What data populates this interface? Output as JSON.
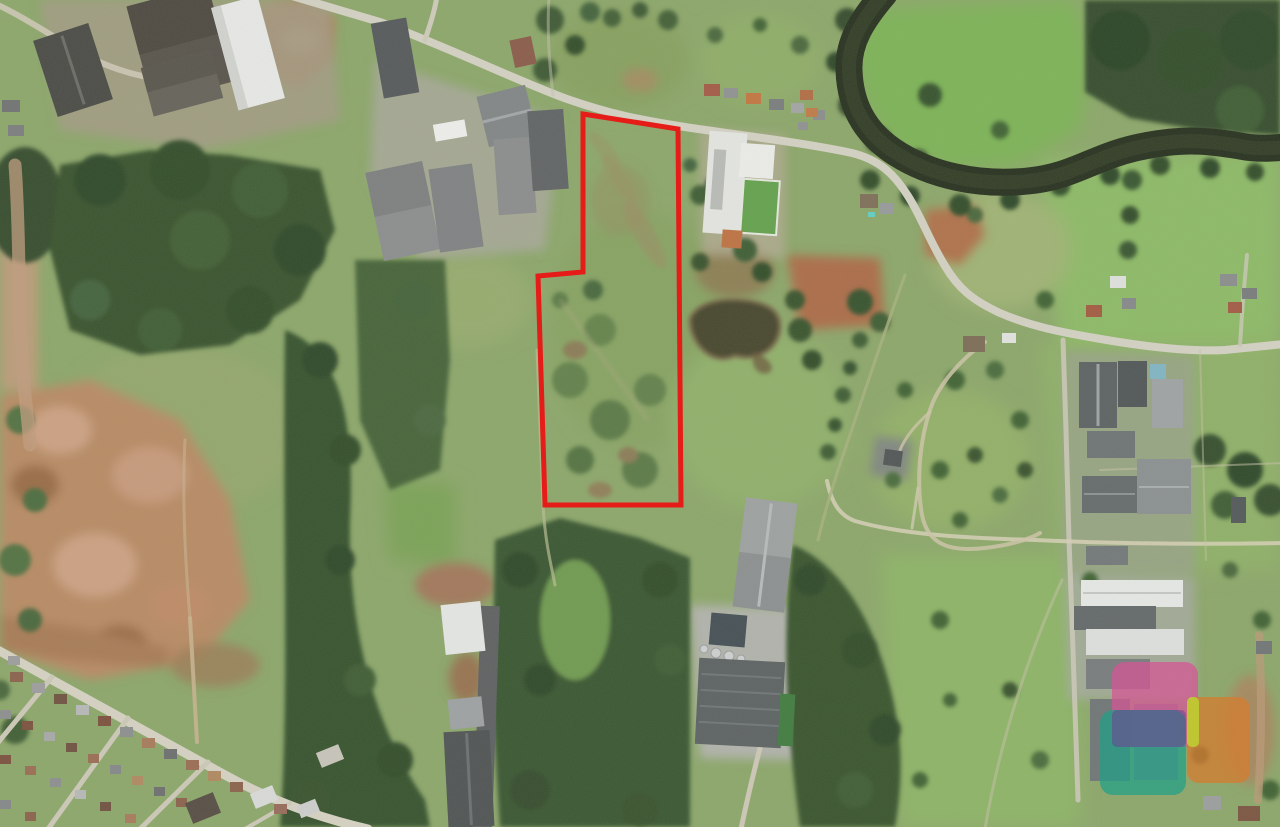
{
  "page": {
    "type": "satellite-aerial-photograph",
    "width": 1280,
    "height": 827,
    "description": "Aerial satellite view of a semi-rural industrial area with pastures, forest strips, a dark meandering river at top right, warehouses, a residential corner at bottom left, a rural land lot outlined in red, and a translucent colored logo watermark at bottom right"
  },
  "overlay": {
    "property_boundary": {
      "points": "583,114 678,129 681,505 545,505 538,276 583,272",
      "stroke_color": "#e51c18",
      "stroke_width": 5,
      "fill": "none"
    },
    "watermark": {
      "shapes": [
        {
          "name": "watermark-pink-square",
          "x": 1112,
          "y": 662,
          "width": 86,
          "height": 85,
          "radius": 13,
          "color": "rgba(215,85,150,0.72)"
        },
        {
          "name": "watermark-teal-square",
          "x": 1100,
          "y": 710,
          "width": 86,
          "height": 85,
          "radius": 13,
          "color": "rgba(32,160,136,0.72)"
        },
        {
          "name": "watermark-purple-overlap",
          "x": 1112,
          "y": 710,
          "width": 74,
          "height": 37,
          "radius": 5,
          "color": "rgba(102,62,145,0.50)"
        },
        {
          "name": "watermark-orange-square",
          "x": 1187,
          "y": 697,
          "width": 63,
          "height": 86,
          "radius": 12,
          "color": "rgba(210,125,50,0.78)"
        },
        {
          "name": "watermark-yellow-bar",
          "x": 1187,
          "y": 697,
          "width": 12,
          "height": 50,
          "radius": 5,
          "color": "rgba(190,205,50,0.9)"
        }
      ]
    }
  },
  "palette": {
    "pasture_base": "#8ca76a",
    "pasture_bright": "#7eb457",
    "pasture_pale": "#a3b277",
    "forest_dark": "#2c4526",
    "forest_mid": "#36522d",
    "river_water": "#232c1b",
    "pond_water": "#3f3c2a",
    "road_light": "#d6d3c6",
    "dirt_track": "#c9b28f",
    "dirt_red": "#ad6b46",
    "dirt_pink": "#c59a80",
    "roof_dark_gray": "#4e5254",
    "roof_mid_gray": "#8a8c8e",
    "roof_white": "#eceded",
    "roof_orange": "#c06b3b",
    "boundary_red": "#e51c18"
  }
}
